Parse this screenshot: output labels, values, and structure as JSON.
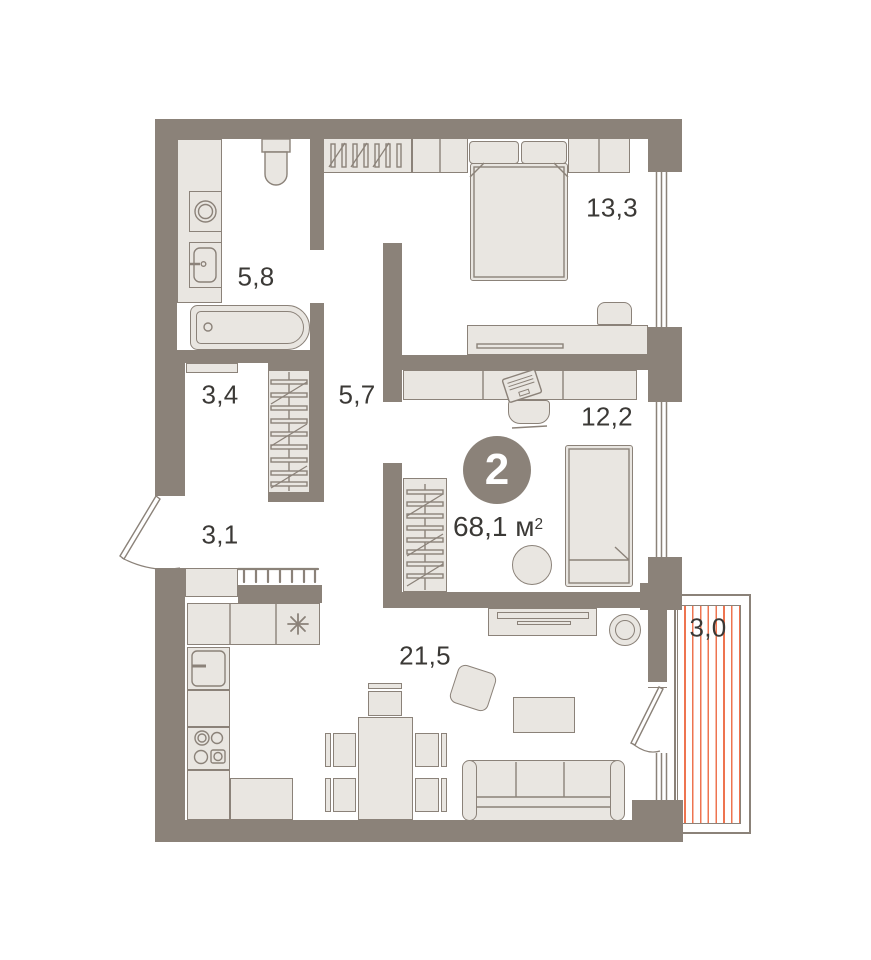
{
  "floorplan": {
    "badge": {
      "rooms_count": "2"
    },
    "total_area": {
      "value": "68,1",
      "unit": "м",
      "superscript": "2"
    },
    "rooms": [
      {
        "id": "bathroom",
        "label": "5,8"
      },
      {
        "id": "storage",
        "label": "3,4"
      },
      {
        "id": "corridor",
        "label": "5,7"
      },
      {
        "id": "entry-hall",
        "label": "3,1"
      },
      {
        "id": "kitchen-living",
        "label": "21,5"
      },
      {
        "id": "bedroom",
        "label": "13,3"
      },
      {
        "id": "bedroom-2",
        "label": "12,2"
      },
      {
        "id": "balcony",
        "label": "3,0"
      }
    ],
    "colors": {
      "wall": "#8b8279",
      "furniture_fill": "#e9e6e1",
      "furniture_stroke": "#8b8279",
      "text": "#3b3936",
      "balcony_hatch": "#ee7450",
      "badge_fill": "#8b8279",
      "badge_text": "#ffffff",
      "background": "#ffffff"
    }
  }
}
